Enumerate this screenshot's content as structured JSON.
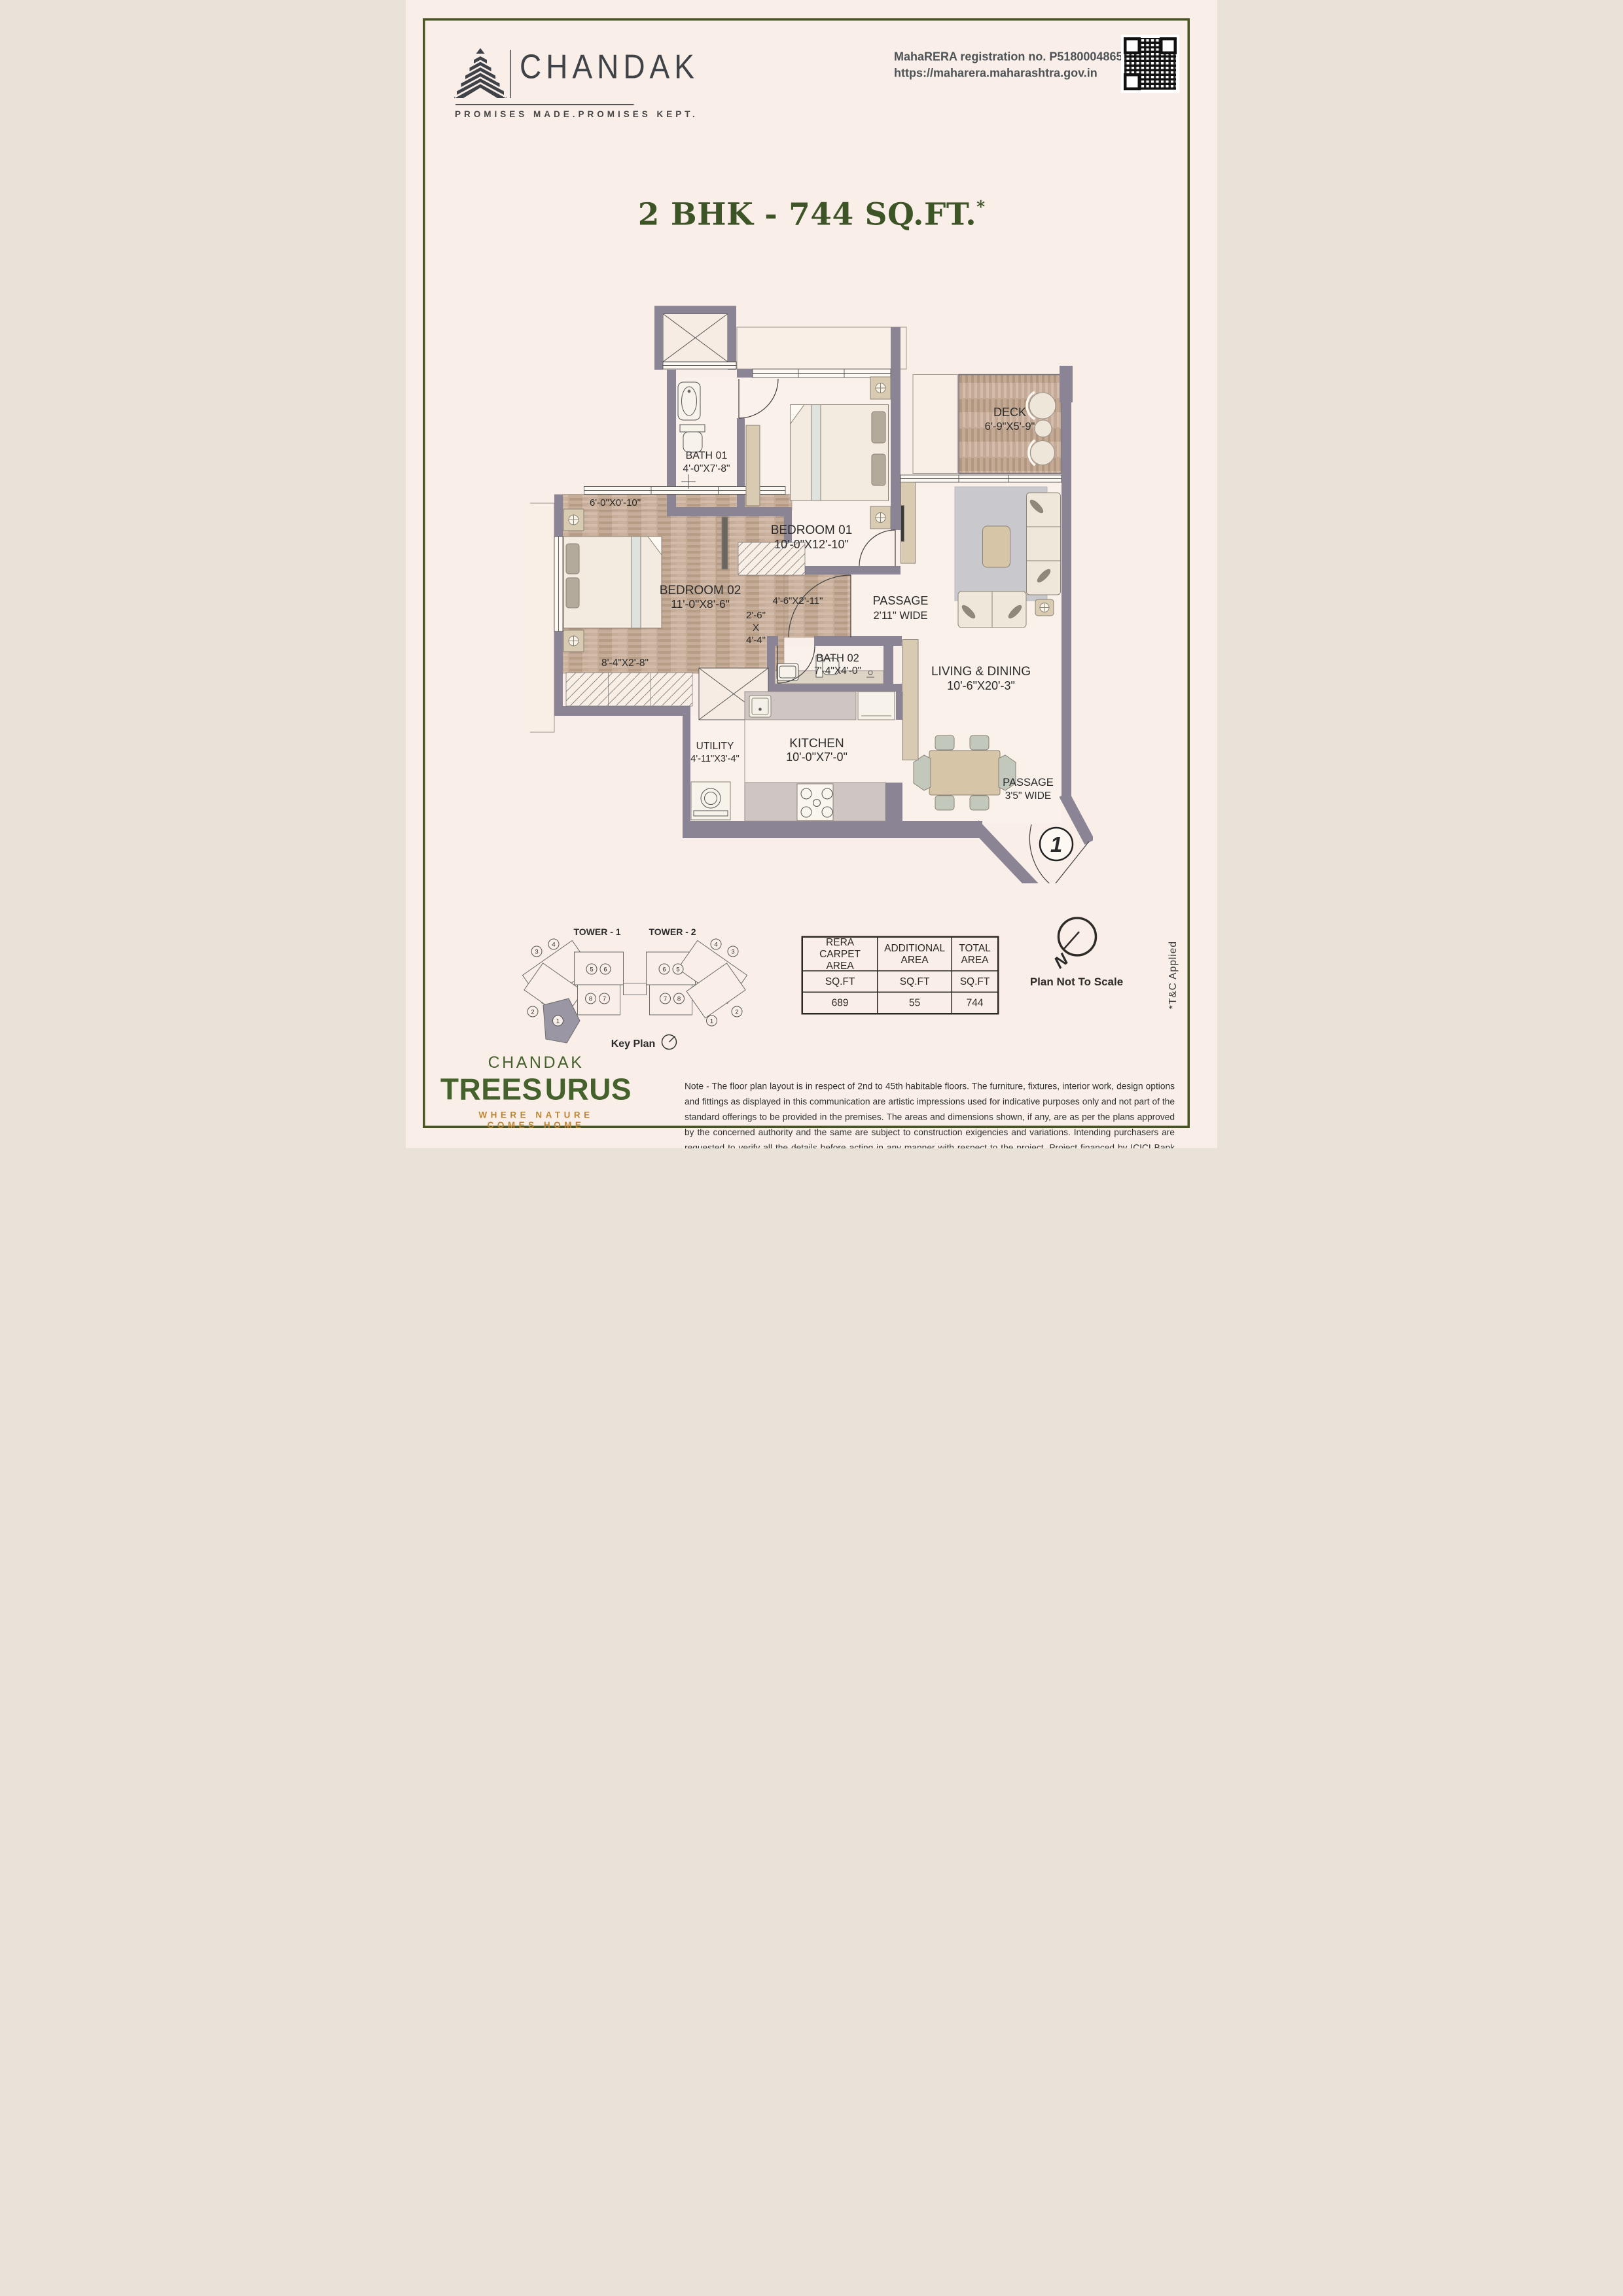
{
  "page": {
    "bg": "#f9efe8",
    "border_color": "#485425"
  },
  "header": {
    "brand_name": "CHANDAK",
    "brand_tagline": "PROMISES MADE.PROMISES KEPT.",
    "rera_line1": "MahaRERA registration no. P51800048658",
    "rera_line2": "https://maharera.maharashtra.gov.in"
  },
  "title": {
    "text": "2 BHK - 744 SQ.FT.",
    "asterisk": "*"
  },
  "plan": {
    "rooms": [
      {
        "name": "BATH 01",
        "dims": "4'-0\"X7'-8\""
      },
      {
        "name": "BEDROOM 01",
        "dims": "10'-0\"X12'-10\""
      },
      {
        "name": "DECK",
        "dims": "6'-9\"X5'-9\""
      },
      {
        "name": "BEDROOM 02",
        "dims": "11'-0\"X8'-6\""
      },
      {
        "name": "PASSAGE",
        "dims": "2'11\" WIDE"
      },
      {
        "name": "BATH 02",
        "dims": "7'-4\"X4'-0\""
      },
      {
        "name": "LIVING & DINING",
        "dims": "10'-6\"X20'-3\""
      },
      {
        "name": "UTILITY",
        "dims": "4'-11\"X3'-4\""
      },
      {
        "name": "KITCHEN",
        "dims": "10'-0\"X7'-0\""
      },
      {
        "name": "PASSAGE",
        "dims": "3'5\" WIDE"
      }
    ],
    "extra_dims": [
      "6'-0\"X0'-10\"",
      "8'-4\"X2'-8\"",
      "4'-6\"X2'-11\"",
      "2'-6\"",
      "X",
      "4'-4\""
    ],
    "entrance_marker": "1"
  },
  "key_plan": {
    "tower1_label": "TOWER - 1",
    "tower2_label": "TOWER - 2",
    "caption": "Key Plan",
    "tower1_units": [
      "3",
      "4",
      "5",
      "6",
      "8",
      "7",
      "2",
      "1"
    ],
    "tower2_units": [
      "4",
      "3",
      "6",
      "5",
      "7",
      "8",
      "1",
      "2"
    ]
  },
  "area_table": {
    "headers": [
      "RERA CARPET AREA",
      "ADDITIONAL AREA",
      "TOTAL AREA"
    ],
    "units": [
      "SQ.FT",
      "SQ.FT",
      "SQ.FT"
    ],
    "values": [
      "689",
      "55",
      "744"
    ]
  },
  "compass": {
    "label": "N",
    "note": "Plan Not To Scale"
  },
  "tnc": "*T&C Applied",
  "footer": {
    "brand_top": "CHANDAK",
    "brand_left": "TREES",
    "brand_right": "URUS",
    "tagline": "WHERE NATURE COMES HOME"
  },
  "note": "Note - The floor plan layout is in respect of 2nd to 45th habitable floors. The furniture, fixtures, interior work, design options and fittings as displayed in this communication are artistic impressions used for indicative purposes only and not part of the standard offerings to be provided in the premises. The areas and dimensions shown, if any, are as per the plans approved by the concerned authority and the same are subject to construction exigencies and variations. Intending purchasers are requested to verify all the details before acting in any manner with respect to the project. Project financed by ICICI Bank Limited."
}
